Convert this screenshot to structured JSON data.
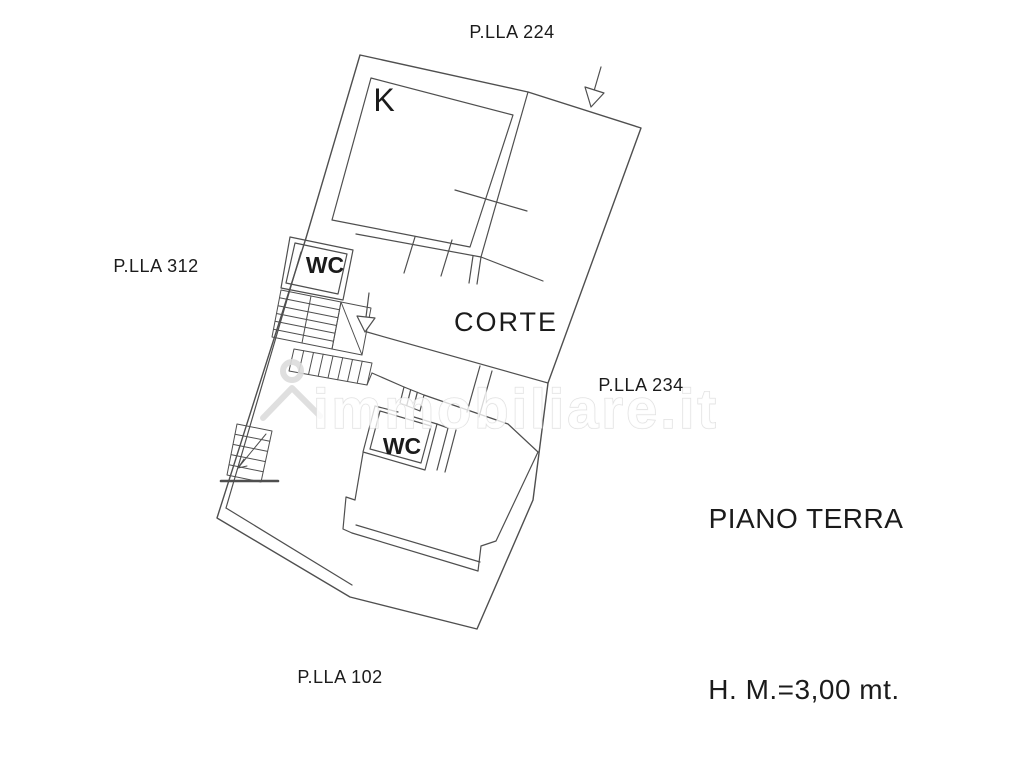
{
  "labels": {
    "parcel_224": "P.LLA 224",
    "parcel_312": "P.LLA 312",
    "parcel_234": "P.LLA 234",
    "parcel_102": "P.LLA 102",
    "kitchen": "K",
    "wc_upper": "WC",
    "wc_lower": "WC",
    "courtyard": "CORTE",
    "floor_title": "PIANO TERRA",
    "height_note": "H. M.=3,00 mt."
  },
  "watermark": {
    "text": "immobiliare.it"
  },
  "colors": {
    "line": "#4f4f4f",
    "text": "#1b1b1b",
    "watermark_stroke": "#dcdcdc",
    "background": "#ffffff"
  }
}
